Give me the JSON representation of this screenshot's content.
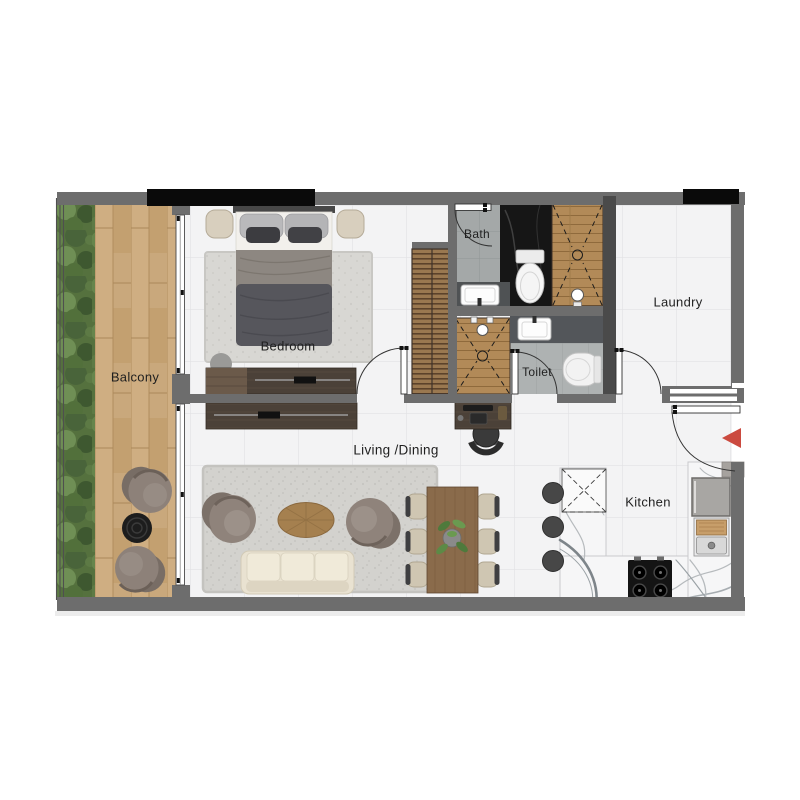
{
  "floorplan": {
    "title": "Apartment floor plan",
    "rooms": {
      "balcony": "Balcony",
      "bedroom": "Bedroom",
      "living_dining": "Living /Dining",
      "bath": "Bath",
      "toilet": "Toilet",
      "laundry": "Laundry",
      "kitchen": "Kitchen"
    },
    "markers": {
      "entry_arrow_direction": "left"
    },
    "colors": {
      "wall": "#6d6d6d",
      "wall_exterior_black": "#0a0a0a",
      "entry_arrow": "#cb4a3f",
      "tile_floor": "#f3f3f4",
      "balcony_deck": "#c9a87c",
      "planting": "#55713e",
      "shower_wood": "#b28a58",
      "black_marble": "#161616",
      "kitchen_marble": "#f6f6f7"
    }
  }
}
